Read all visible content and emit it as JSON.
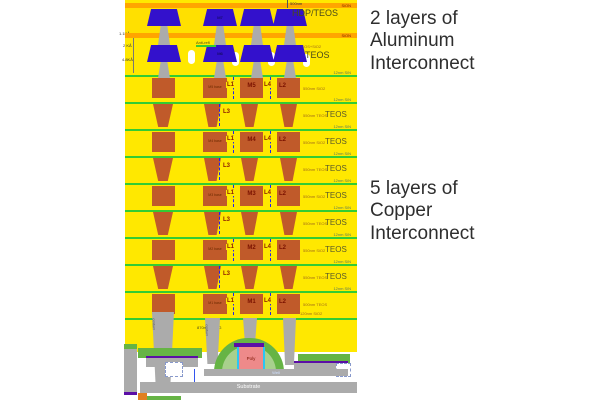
{
  "annotations": {
    "aluminum": "2 layers of\nAluminum\nInterconnect",
    "copper": "5 layers of\nCopper\nInterconnect"
  },
  "colors": {
    "dielectric_yellow": "#FFE800",
    "passivation_orange": "#FFA500",
    "aluminum_blue": "#3311CC",
    "copper_orange": "#C05A2A",
    "via_gray": "#ABABAB",
    "sin_green": "#33CC33",
    "device_green": "#66B445",
    "poly_pink": "#EE8A8A",
    "oxide_cyan": "#29C5F6",
    "silicide_purple": "#5B0EA6"
  },
  "top": {
    "dim_500nm": "500nm",
    "strip1_label": "SiON",
    "strip2_label": "SiON",
    "hdp_teos": "HDP/TEOS",
    "teos": "TEOS",
    "teos_small": "TEOS+SiO2",
    "m7": "M7",
    "m6": "M6",
    "anti_refl": "Anti-refl",
    "dim1": "1.1KÅ",
    "dim2": "2 KÅ",
    "dim3": "4.8KÅ"
  },
  "copper": {
    "metal_rows": [
      {
        "metal": "M5",
        "base": "M5 base",
        "l1": "L1",
        "l4": "L4",
        "l2": "L2",
        "sin": "12nm SiN",
        "small": "550nm SiO2",
        "teos": ""
      },
      {
        "metal": "M4",
        "base": "M4 base",
        "l1": "L1",
        "l4": "L4",
        "l2": "L2",
        "sin": "12nm SiN",
        "small": "550nm SiO2",
        "teos": "TEOS"
      },
      {
        "metal": "M3",
        "base": "M3 base",
        "l1": "L1",
        "l4": "L4",
        "l2": "L2",
        "sin": "12nm SiN",
        "small": "550nm SiO2",
        "teos": "TEOS"
      },
      {
        "metal": "M2",
        "base": "M2 base",
        "l1": "L1",
        "l4": "L4",
        "l2": "L2",
        "sin": "12nm SiN",
        "small": "550nm SiO2",
        "teos": "TEOS"
      },
      {
        "metal": "M1",
        "base": "M1 base",
        "l1": "L1",
        "l4": "L4",
        "l2": "L2",
        "sin": "12nm SiN",
        "small": "500nm TEOS",
        "teos": ""
      }
    ],
    "via_rows": [
      {
        "l3": "L3",
        "sin": "12nm SiN",
        "small": "550nm TEOS",
        "teos": "TEOS"
      },
      {
        "l3": "L3",
        "sin": "12nm SiN",
        "small": "550nm TEOS",
        "teos": "TEOS"
      },
      {
        "l3": "L3",
        "sin": "12nm SiN",
        "small": "550nm TEOS",
        "teos": "TEOS"
      },
      {
        "l3": "L3",
        "sin": "12nm SiN",
        "small": "550nm TEOS",
        "teos": "TEOS"
      }
    ]
  },
  "bottom": {
    "sio2_label": "120nm SiO2",
    "bpsg_label": "870nm BPSG",
    "contact_label": "contact",
    "poly": "Poly",
    "well": "Well",
    "substrate": "Substrate"
  }
}
